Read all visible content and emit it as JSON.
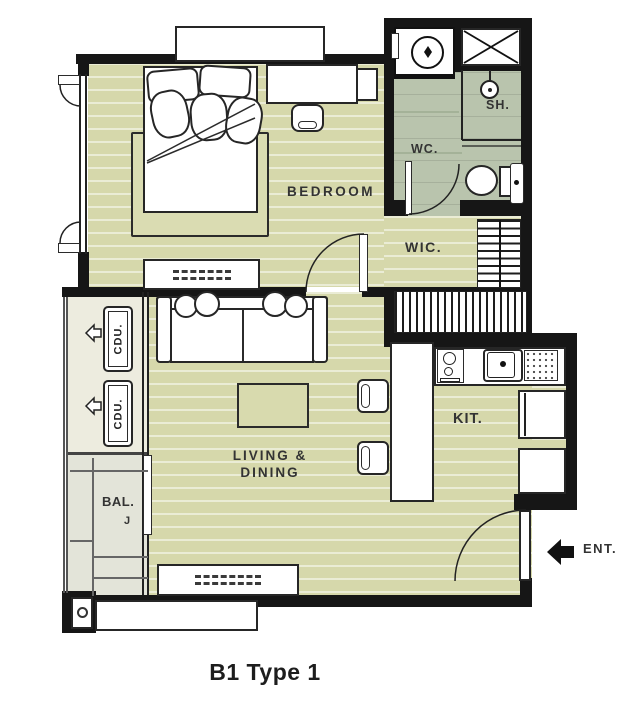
{
  "plan": {
    "caption": "B1 Type 1",
    "labels": {
      "bedroom": "BEDROOM",
      "wc": "WC.",
      "shower": "SH.",
      "wic": "WIC.",
      "kitchen": "KIT.",
      "living1": "LIVING &",
      "living2": "DINING",
      "balcony": "BAL.",
      "balcony_mark": "J",
      "cdu_upper": "CDU.",
      "cdu_lower": "CDU.",
      "entrance": "ENT."
    },
    "colors": {
      "wall": "#161616",
      "floor_wood": "#d6d8ab",
      "floor_bath": "#b9c4ad",
      "floor_balcony": "#e3e4d9",
      "floor_ledge": "#edecdf",
      "accent_text": "#333333"
    }
  }
}
